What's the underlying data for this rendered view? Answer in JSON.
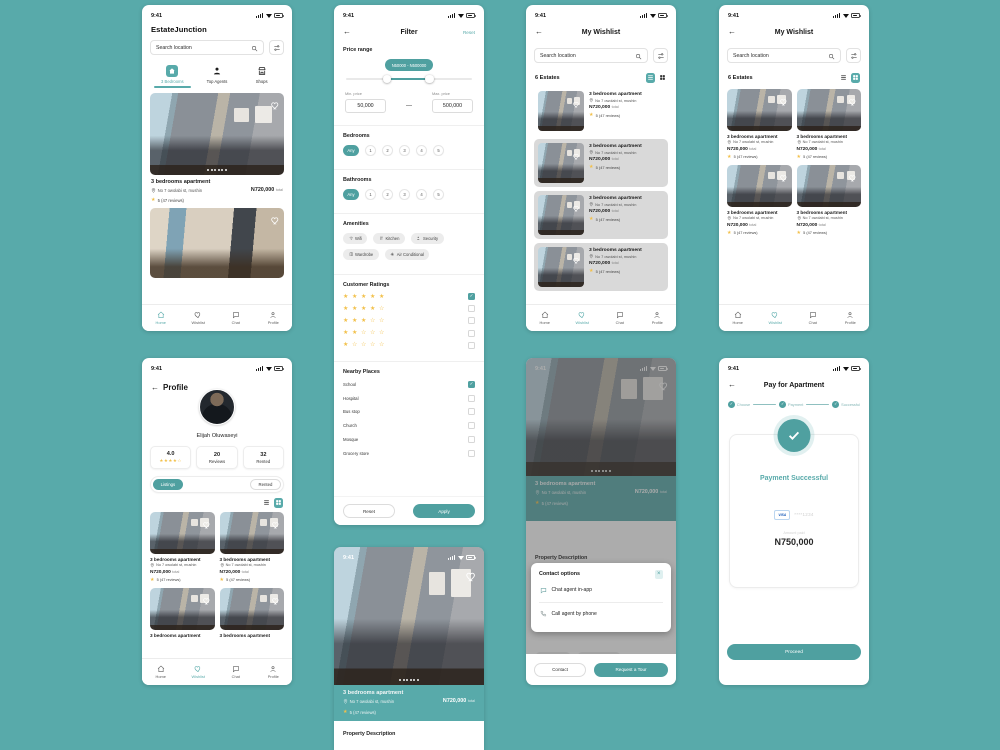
{
  "colors": {
    "background": "#58AAAA",
    "accent": "#4FA0A0",
    "star": "#F2C04A",
    "wishlist_card": "#D9D9D9"
  },
  "statusbar": {
    "time": "9:41"
  },
  "nav": {
    "home": "Home",
    "wishlist": "Wishlist",
    "chat": "Chat",
    "profile": "Profile"
  },
  "search": {
    "placeholder": "Search location"
  },
  "listing": {
    "title": "3 bedrooms apartment",
    "address": "No 7 owolabi st, mushin",
    "price": "N720,000",
    "price_suffix": "total",
    "rating": "5 (47 reviews)"
  },
  "home": {
    "app_title": "EstateJunction",
    "tabs": [
      {
        "label": "3 Bedrooms"
      },
      {
        "label": "Top Agents"
      },
      {
        "label": "Shops"
      }
    ]
  },
  "filter": {
    "title": "Filter",
    "reset_link": "Reset",
    "price_range_label": "Price range",
    "slider_value": "N50000 - N500000",
    "min_label": "Min. price",
    "min_value": "50,000",
    "dash": "—",
    "max_label": "Max. price",
    "max_value": "500,000",
    "bedrooms_label": "Bedrooms",
    "bathrooms_label": "Bathrooms",
    "options": [
      "Any",
      "1",
      "2",
      "3",
      "4",
      "5"
    ],
    "amenities_label": "Amenities",
    "amenities": [
      "Wifi",
      "Kitchen",
      "Security",
      "Wardrobe",
      "Air Conditional"
    ],
    "ratings_label": "Customer Ratings",
    "ratings": [
      {
        "stars": "★ ★ ★ ★ ★",
        "checked": true
      },
      {
        "stars": "★ ★ ★ ★ ☆",
        "checked": false
      },
      {
        "stars": "★ ★ ★ ☆ ☆",
        "checked": false
      },
      {
        "stars": "★ ★ ☆ ☆ ☆",
        "checked": false
      },
      {
        "stars": "★ ☆ ☆ ☆ ☆",
        "checked": false
      }
    ],
    "nearby_label": "Nearby Places",
    "nearby": [
      "School",
      "Hospital",
      "Bus stop",
      "Church",
      "Mosque",
      "Grocery store"
    ],
    "reset_button": "Reset",
    "apply_button": "Apply"
  },
  "wishlist": {
    "title": "My Wishlist",
    "count": "6 Estates"
  },
  "profile": {
    "title": "Profile",
    "name": "Elijah Oluwaseyi",
    "stats": [
      {
        "value": "4.0",
        "stars": "★★★★☆"
      },
      {
        "value": "20",
        "label": "Reviews"
      },
      {
        "value": "32",
        "label": "Rented"
      }
    ],
    "tab_listings": "Listings",
    "tab_rented": "Rented"
  },
  "detail": {
    "description_label": "Property Description"
  },
  "modal": {
    "title": "Contact options",
    "chat_option": "Chat agent in-app",
    "call_option": "Call agent by phone",
    "contact_button": "Contact",
    "tour_button": "Request a Tour"
  },
  "payment": {
    "title": "Pay for Apartment",
    "steps": [
      "Choose",
      "Payment",
      "Successful"
    ],
    "success_text": "Payment Successful",
    "card_brand": "VISA",
    "card_number": "****1234",
    "amount_label": "Amount paid",
    "amount": "N750,000",
    "proceed_button": "Proceed"
  }
}
